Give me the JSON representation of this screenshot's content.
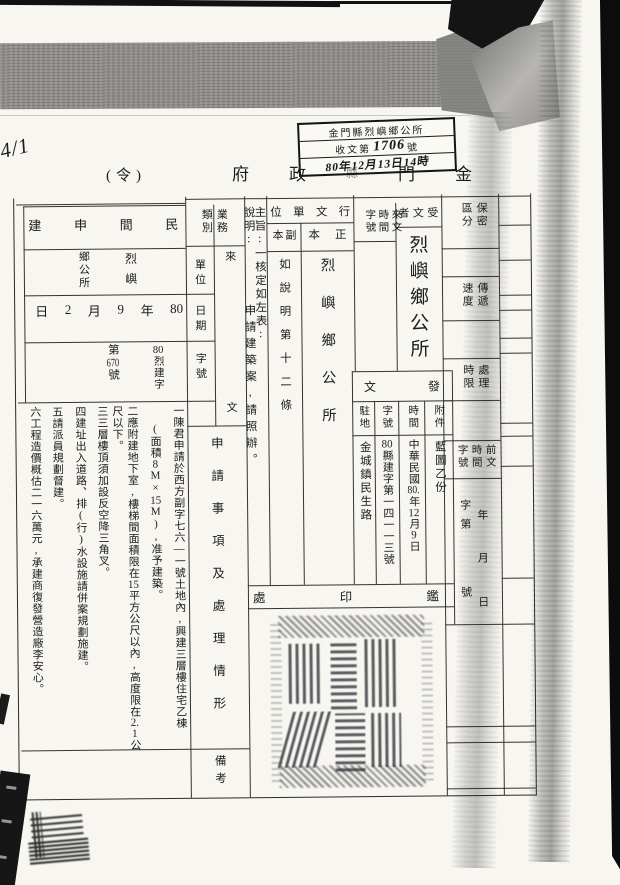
{
  "page": {
    "marker": "4/1"
  },
  "received_stamp": {
    "office": "金門縣烈嶼鄉公所",
    "receipt_prefix": "收文第",
    "receipt_number": "1706",
    "receipt_suffix": "號",
    "datetime": "80年12月13日14時"
  },
  "title": {
    "order": "(令)",
    "agency": "金門縣政府"
  },
  "form": {
    "classification_label": "保密區分",
    "speed_label": "傳遞速度",
    "deadline_label": "處理時限",
    "recipient_label": "受文者",
    "recipient_value": "烈嶼鄉公所",
    "incoming_label": "來文時間字號",
    "dispatch_label": "行文單位",
    "original_label": "正本",
    "original_value": "烈嶼鄉公所",
    "copy_label": "副本",
    "copy_value": "如說明第十二條",
    "subject_text": "主旨:一核定如左表:",
    "explanation_label": "說明:",
    "explanation_text": "申請建築案,請照辦。",
    "issue_label": "發文",
    "attachment_label": "附件",
    "attachment_value": "藍圖乙份",
    "time_label": "時間",
    "time_value": "中華民國80.年12月9日",
    "number_label": "字號",
    "number_value": "80縣建字第一四一一三號",
    "station_label": "駐地",
    "station_value": "金城鎮民生路",
    "prev_doc_label": "前文時間字號",
    "prev_year": "年",
    "prev_month": "月",
    "prev_day": "日",
    "prev_word": "字第",
    "prev_no": "號",
    "seal_section": "鑑印處"
  },
  "left_table": {
    "category_label": "業務類別",
    "incoming_label": "來文",
    "unit_label": "單位",
    "date_label": "日期",
    "number_label": "字號",
    "items_label": "申請事項及處理情形",
    "remarks_label": "備考",
    "category_value": "民間申建",
    "unit_value_right": "烈嶼",
    "unit_value_left": "鄉公所",
    "date_value": "80年9月2日",
    "number_value_prefix": "80烈建字",
    "number_value_main": "第670號",
    "items": [
      "一陳君申請於西方副字七六—一號土地內,興建三層樓住宅乙棟",
      "(面積8M×15M),准予建築。",
      "二應附建地下室,樓梯間面積限在15平方公尺以內,高度限在2.1公",
      "尺以下。",
      "三三層樓頂須加設反空降三角叉。",
      "四建址出入道路、排(行)水設施請併案規劃施建。",
      "五請派員規劃督建。",
      "六工程造價概估二一六萬元,承建商復發營造廠李安心。"
    ]
  }
}
